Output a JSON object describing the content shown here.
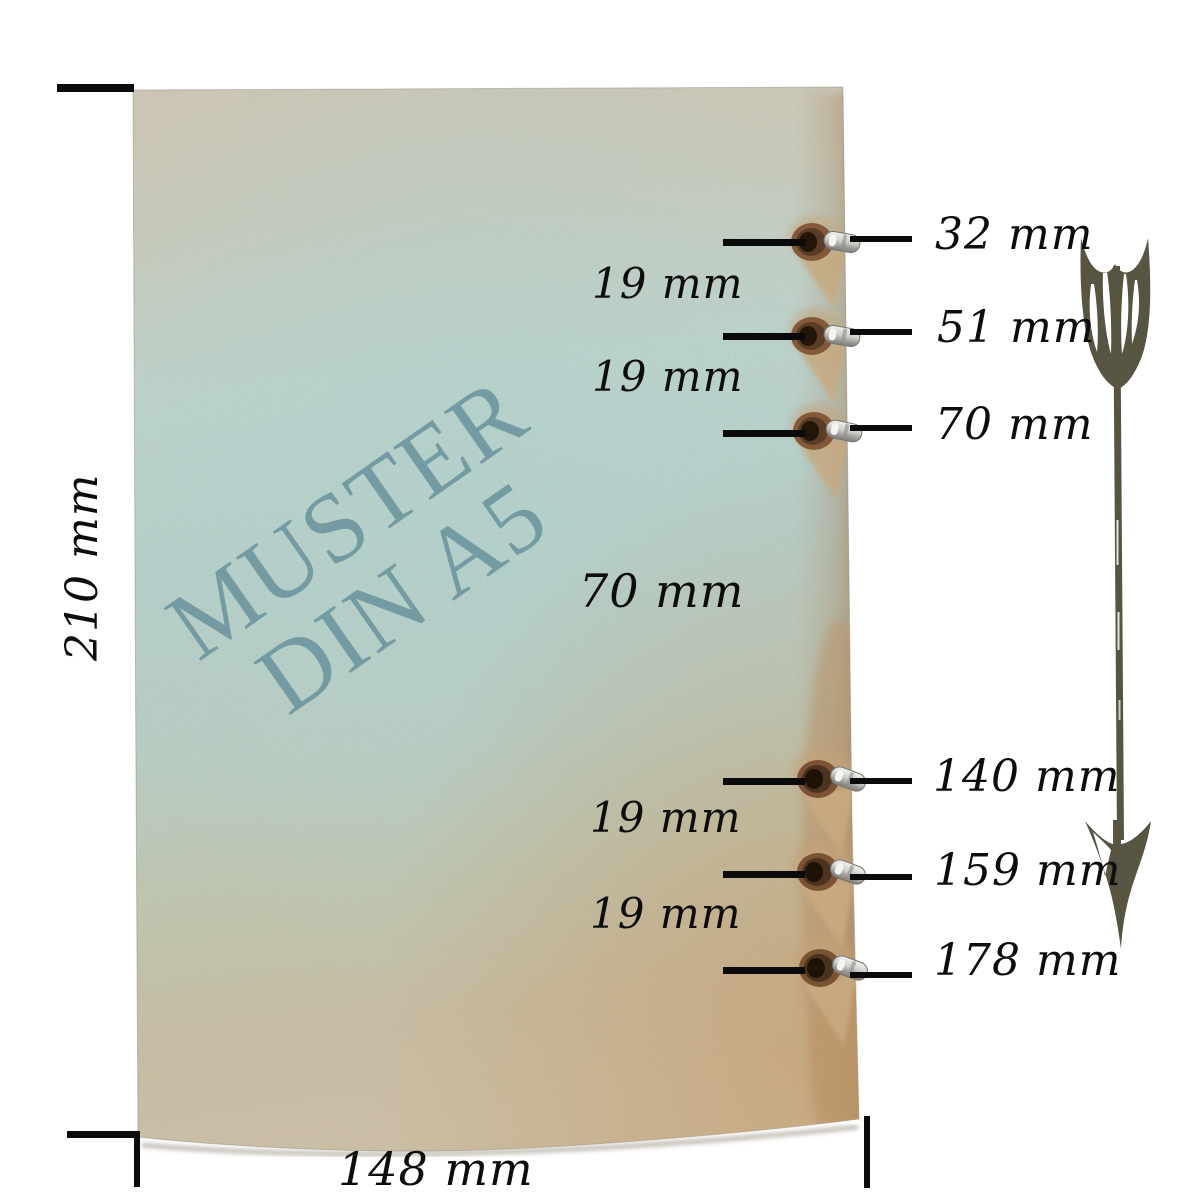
{
  "paper": {
    "watermark_line1": "MUSTER",
    "watermark_line2": "DIN A5",
    "hole_count": 6
  },
  "dimension_labels": {
    "height": "210 mm",
    "width": "148 mm"
  },
  "hole_position_labels": [
    {
      "text": "32 mm"
    },
    {
      "text": "51 mm"
    },
    {
      "text": "70 mm"
    },
    {
      "text": "140 mm"
    },
    {
      "text": "159 mm"
    },
    {
      "text": "178 mm"
    }
  ],
  "spacing_labels": [
    {
      "text": "19 mm"
    },
    {
      "text": "19 mm"
    },
    {
      "text": "70 mm"
    },
    {
      "text": "19 mm"
    },
    {
      "text": "19 mm"
    }
  ],
  "icons": {
    "arrow": "ornate-feathered-arrow-down"
  },
  "colors": {
    "background": "#ffffff",
    "dimension_line": "#0b0b0b",
    "label_text": "#0d0d0d",
    "watermark": "#6f96a0",
    "paper_top": "#cdc5b4",
    "paper_blue": "#b5cec9",
    "paper_bottom": "#cabfa6",
    "kraft_edge": "#ac8560",
    "hole_ring": "#84593a",
    "eyelet_metal": "#cfcfcb",
    "arrow": "#575442"
  }
}
